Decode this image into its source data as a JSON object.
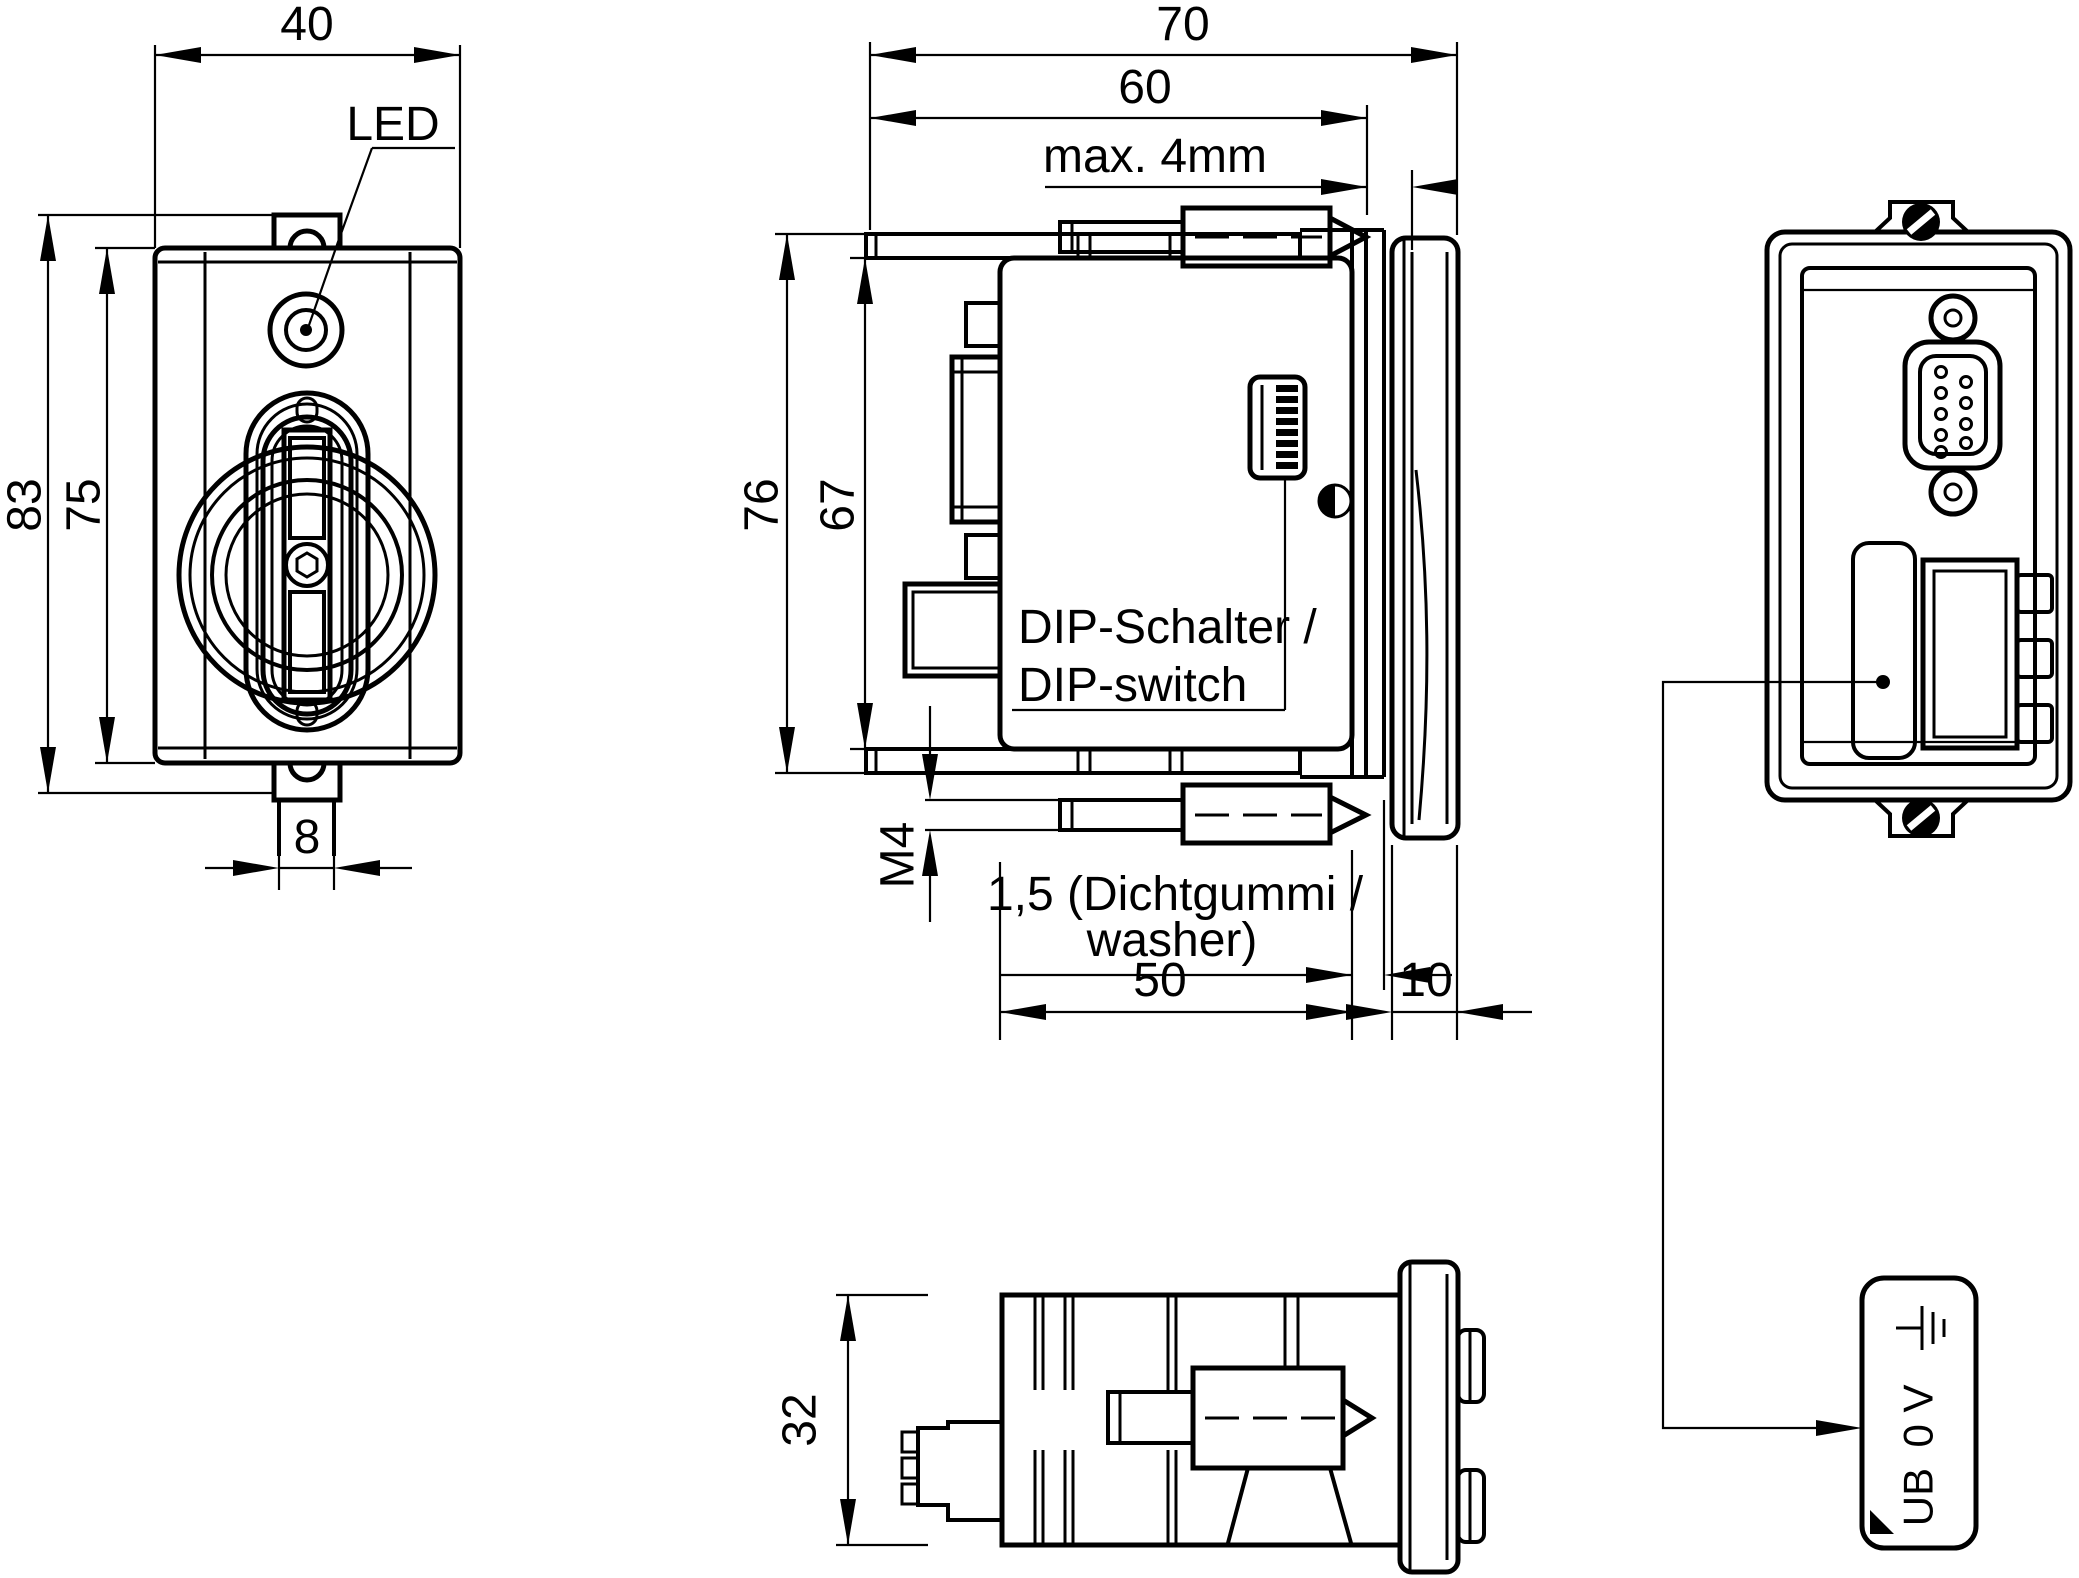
{
  "drawing": {
    "ink_color": "#000000",
    "paper_color": "#ffffff",
    "front_view": {
      "dim_width": "40",
      "dim_outer_height": "83",
      "dim_face_height": "75",
      "dim_tab_width": "8",
      "led_label": "LED"
    },
    "side_view": {
      "dim_total_depth": "70",
      "dim_screw_depth": "60",
      "panel_note": "max. 4mm",
      "dim_outer_height": "76",
      "dim_body_height": "67",
      "thread_label": "M4",
      "washer_line1": "1,5 (Dichtgummi /",
      "washer_line2": "washer)",
      "dip_line1": "DIP-Schalter /",
      "dip_line2": "DIP-switch",
      "dim_body_depth": "50",
      "dim_bezel_depth": "10"
    },
    "bottom_view": {
      "dim_depth": "32"
    },
    "rear_view": {
      "terminal_line1": "UB",
      "terminal_line2": "0 V"
    }
  }
}
